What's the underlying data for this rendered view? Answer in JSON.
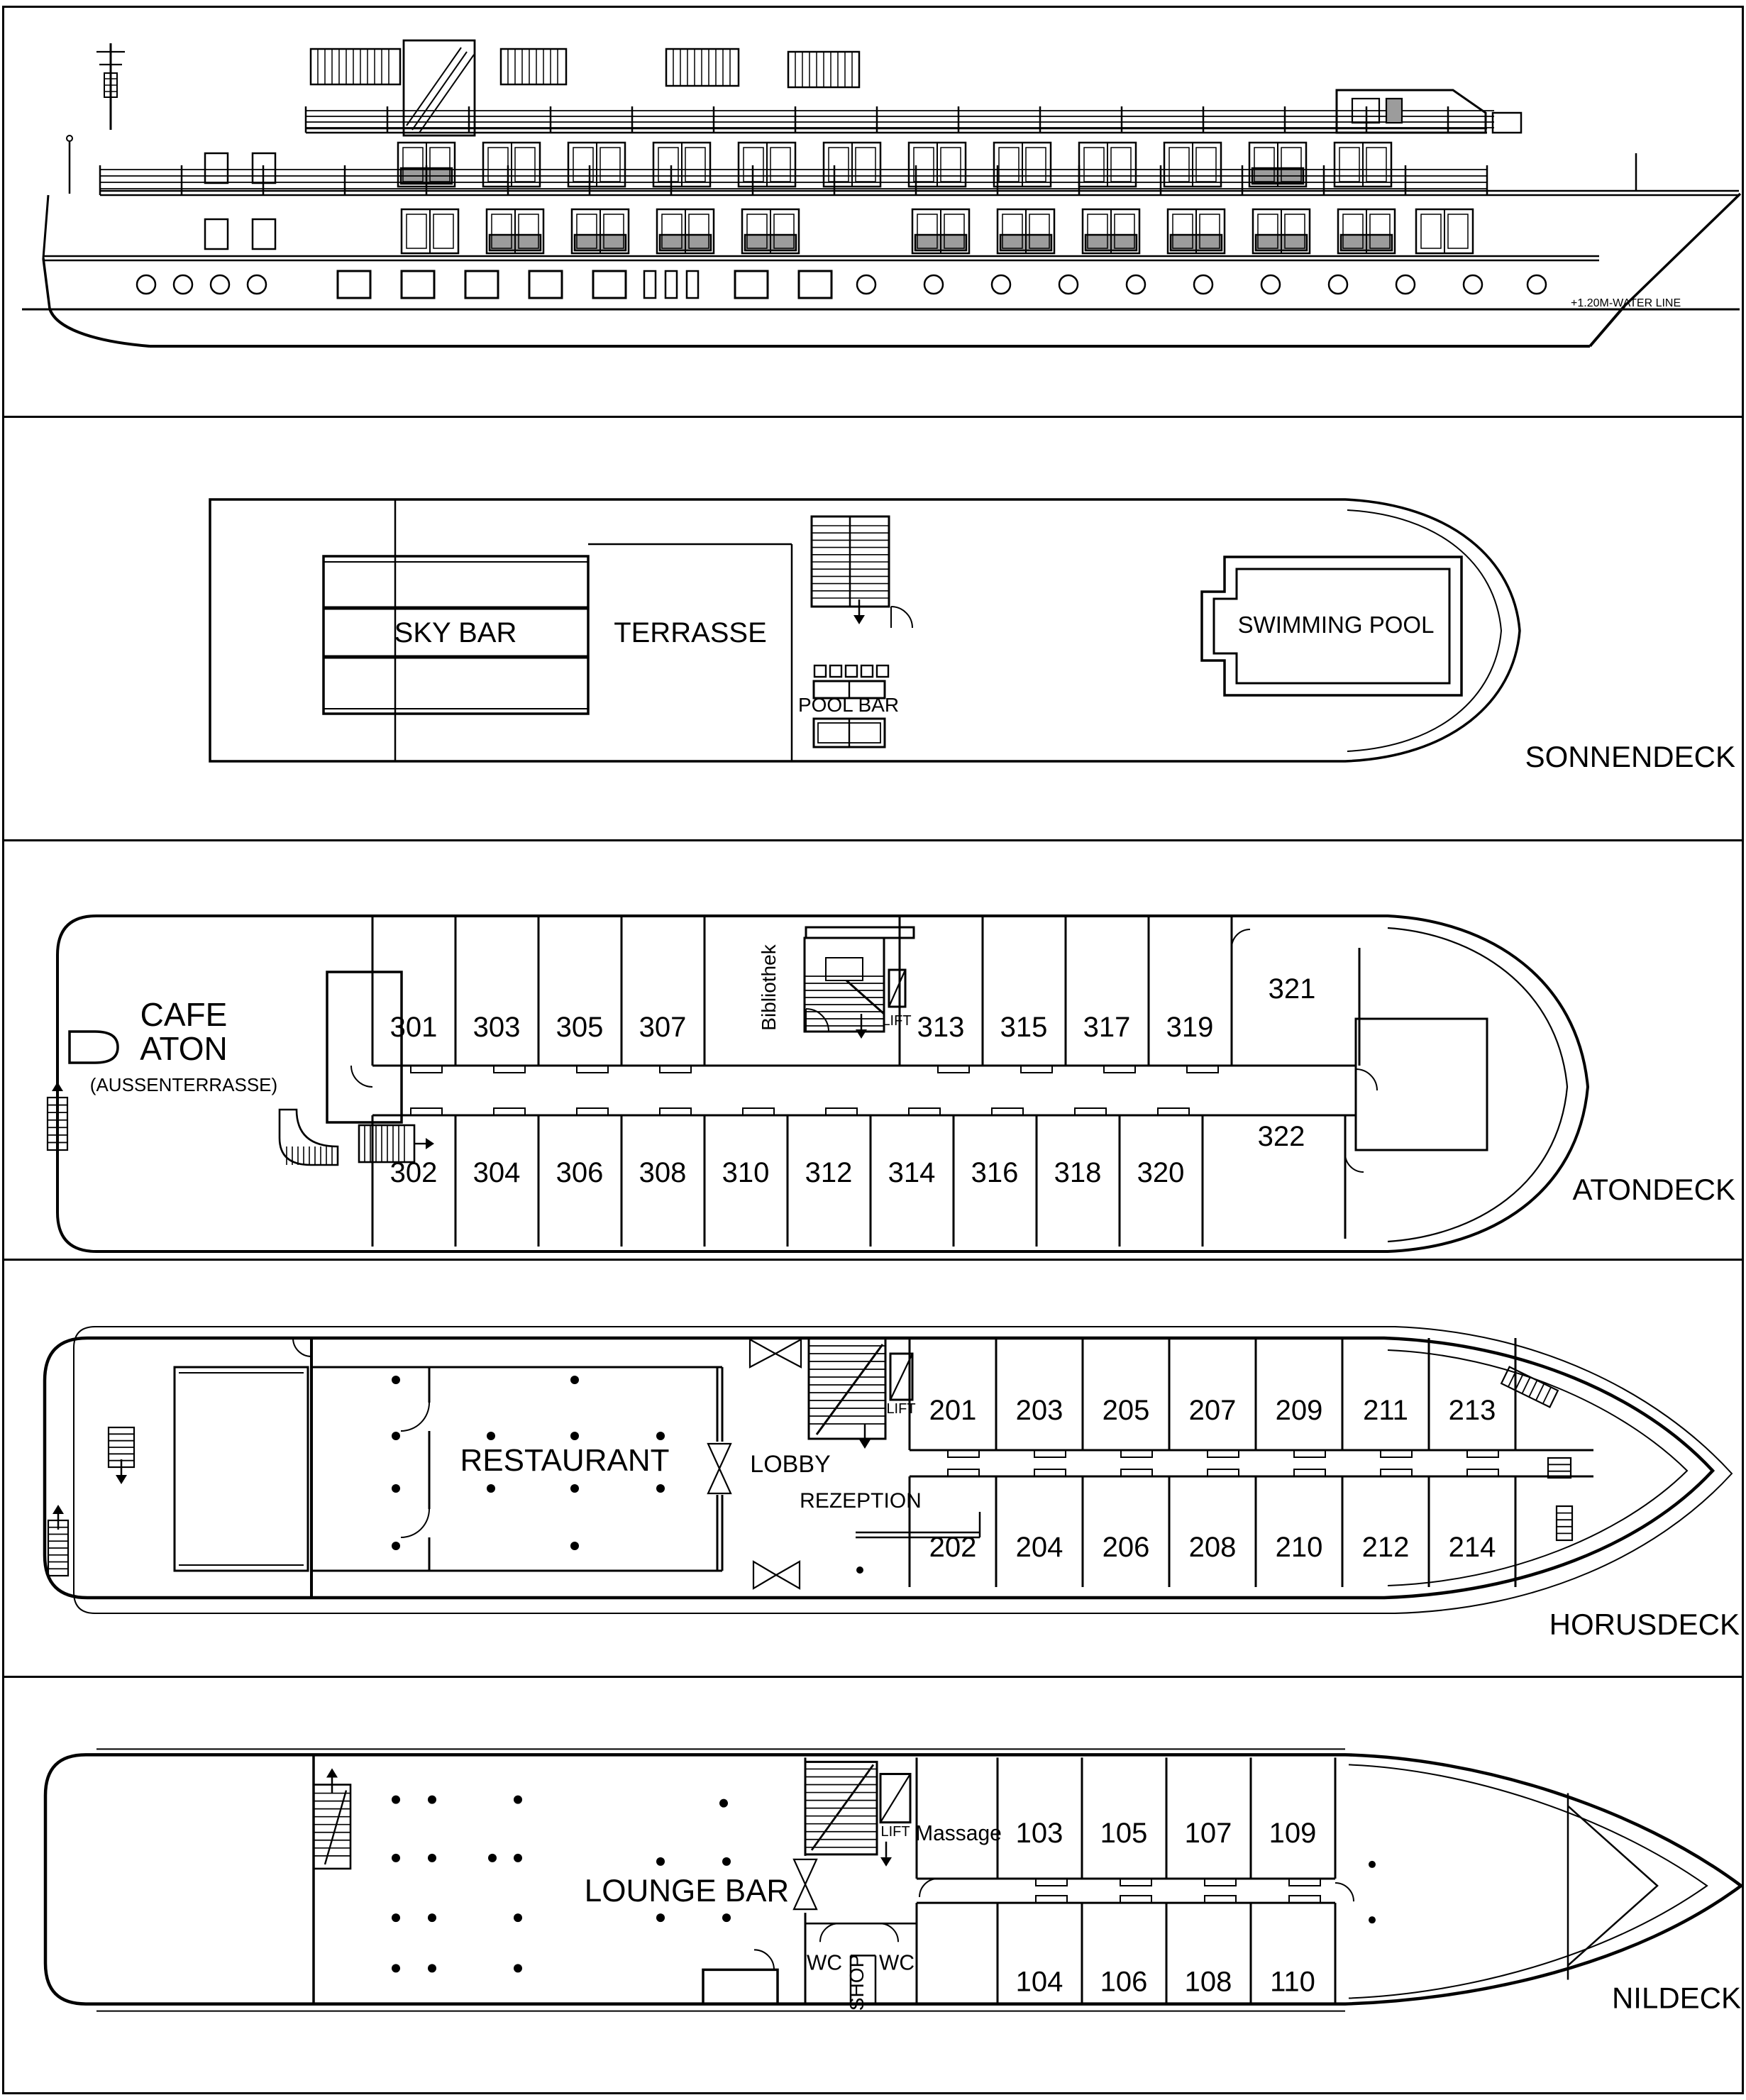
{
  "elevation": {
    "waterline_label": "+1.20M-WATER LINE"
  },
  "decks": {
    "sonnendeck": {
      "label": "SONNENDECK",
      "sky_bar": "SKY BAR",
      "terrasse": "TERRASSE",
      "pool_bar": "POOL BAR",
      "swimming_pool": "SWIMMING POOL"
    },
    "atondeck": {
      "label": "ATONDECK",
      "cafe_line1": "CAFE",
      "cafe_line2": "ATON",
      "cafe_line3": "(AUSSENTERRASSE)",
      "bibliothek": "Bibliothek",
      "lift": "LIFT",
      "cabins_top": [
        "301",
        "303",
        "305",
        "307",
        "313",
        "315",
        "317",
        "319",
        "321"
      ],
      "cabins_bottom": [
        "302",
        "304",
        "306",
        "308",
        "310",
        "312",
        "314",
        "316",
        "318",
        "320",
        "322"
      ]
    },
    "horusdeck": {
      "label": "HORUSDECK",
      "restaurant": "RESTAURANT",
      "lobby": "LOBBY",
      "rezeption": "REZEPTION",
      "lift": "LIFT",
      "cabins_top": [
        "201",
        "203",
        "205",
        "207",
        "209",
        "211",
        "213"
      ],
      "cabins_bottom": [
        "202",
        "204",
        "206",
        "208",
        "210",
        "212",
        "214"
      ]
    },
    "nildeck": {
      "label": "NILDECK",
      "lounge_bar": "LOUNGE BAR",
      "massage": "Massage",
      "shop": "SHOP",
      "wc_left": "WC",
      "wc_right": "WC",
      "lift": "LIFT",
      "cabins_top": [
        "103",
        "105",
        "107",
        "109"
      ],
      "cabins_bottom": [
        "104",
        "106",
        "108",
        "110"
      ]
    }
  },
  "colors": {
    "ink": "#000000",
    "window_gray": "#9c9c9c"
  }
}
